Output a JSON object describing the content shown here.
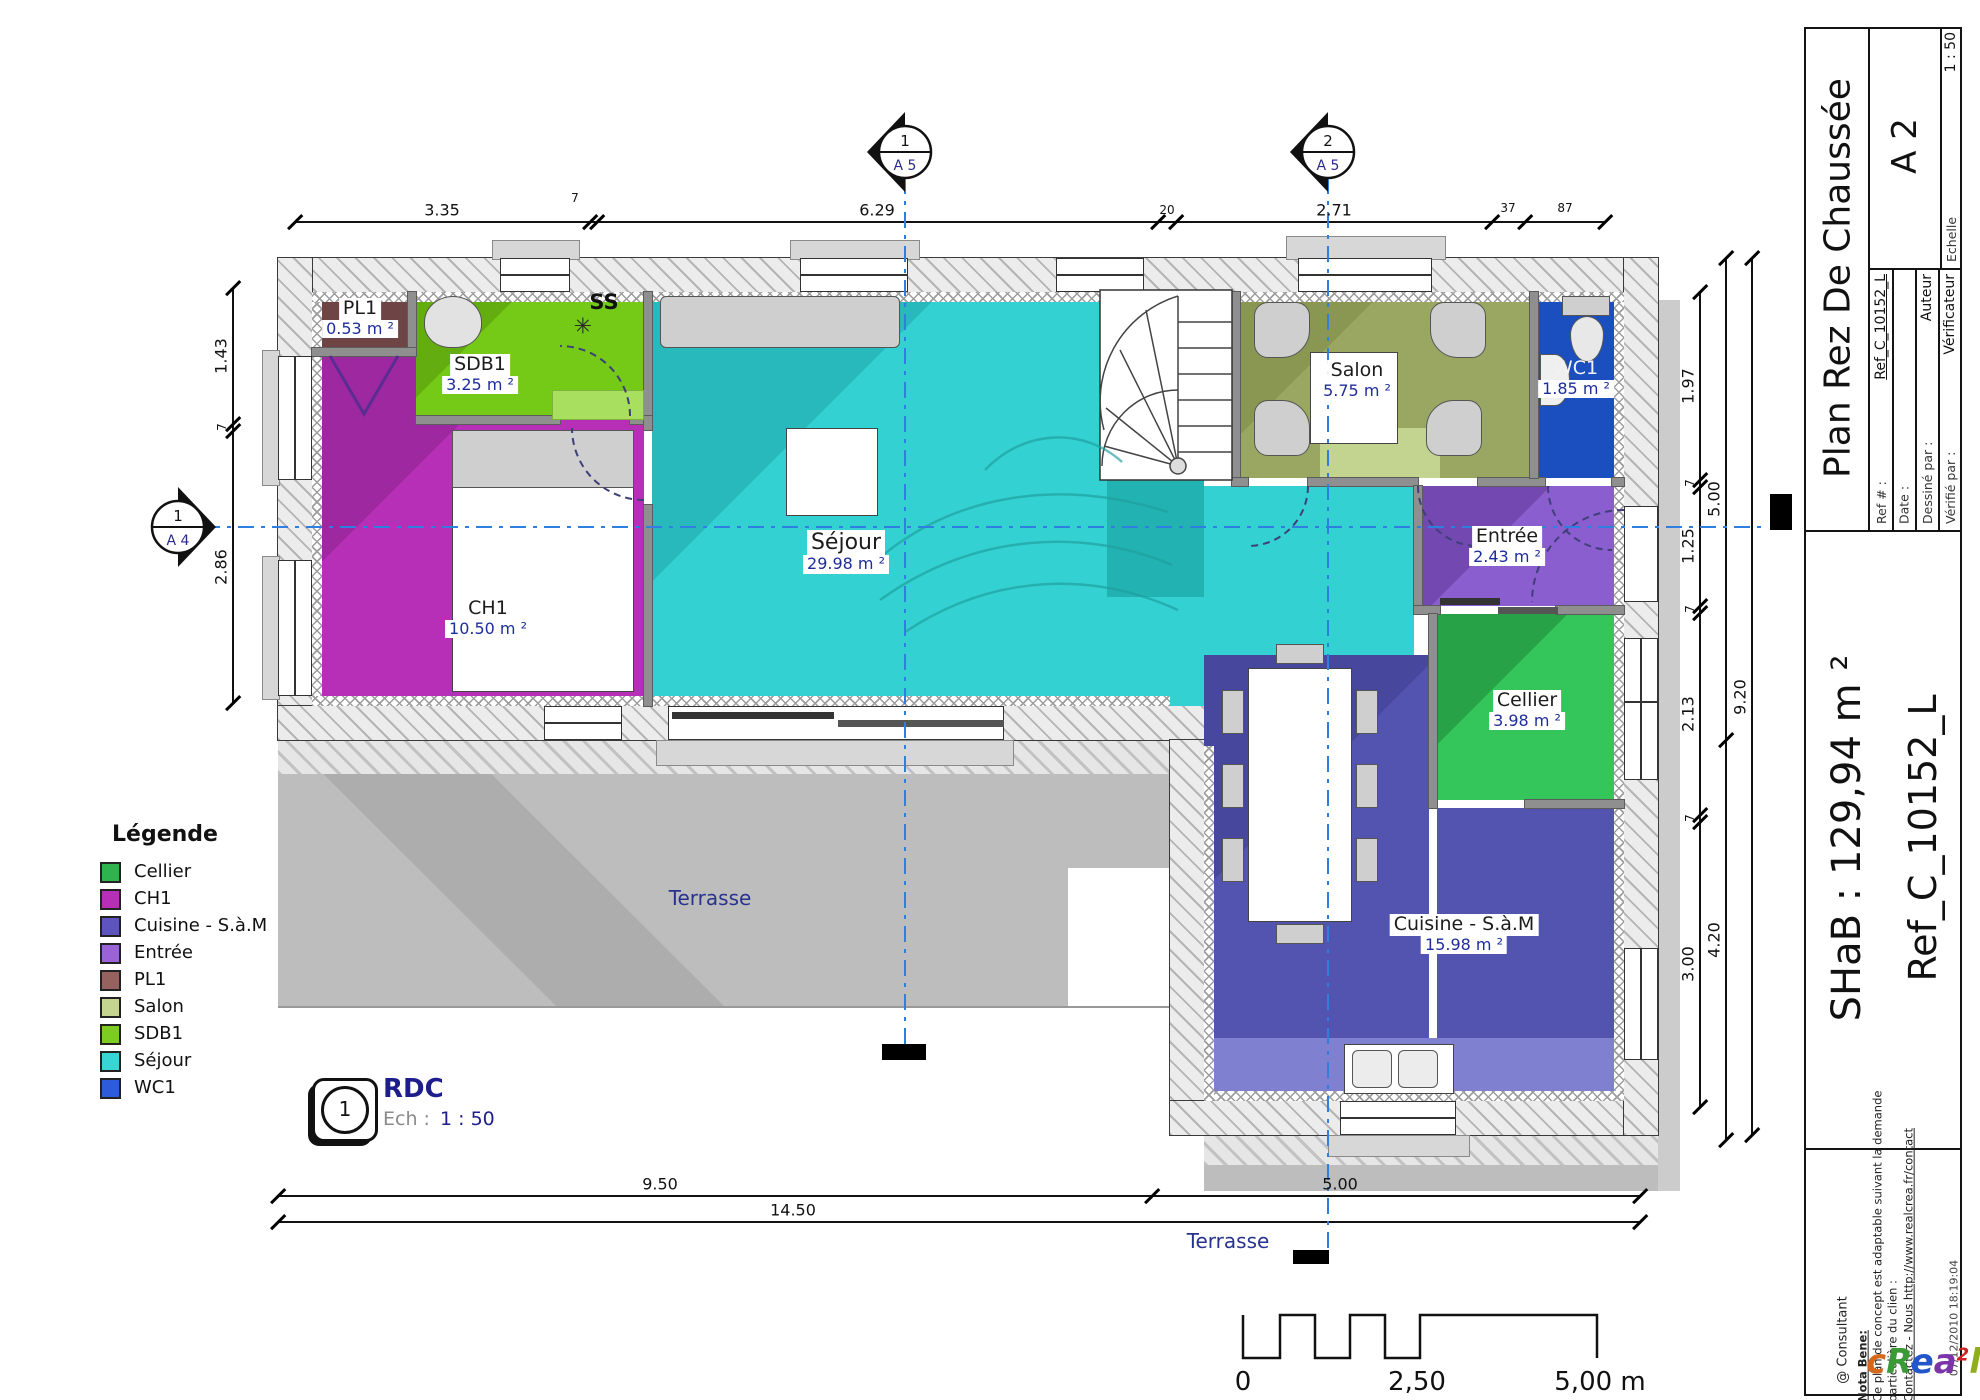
{
  "rooms": [
    {
      "name": "PL1",
      "area": "0.53 m ²",
      "color": "#6e4444"
    },
    {
      "name": "SDB1",
      "area": "3.25 m ²",
      "color": "#70c313"
    },
    {
      "name": "CH1",
      "area": "10.50 m ²",
      "color": "#b72fb7"
    },
    {
      "name": "Séjour",
      "area": "29.98 m ²",
      "color": "#33d1d1"
    },
    {
      "name": "Salon",
      "area": "5.75 m ²",
      "color": "#9aa763"
    },
    {
      "name": "WC1",
      "area": "1.85 m ²",
      "color": "#1b4fc0"
    },
    {
      "name": "Entrée",
      "area": "2.43 m ²",
      "color": "#8a5ecf"
    },
    {
      "name": "Cellier",
      "area": "3.98 m ²",
      "color": "#2db44f"
    },
    {
      "name": "Cuisine - S.à.M",
      "area": "15.98 m ²",
      "color": "#5353b0"
    }
  ],
  "annotations": {
    "ss": "SS",
    "terrasse_left": "Terrasse",
    "terrasse_bottom": "Terrasse"
  },
  "dims": {
    "top": [
      "3.35",
      "7",
      "6.29",
      "20",
      "2.71",
      "37",
      "87"
    ],
    "left": [
      "1.43",
      "7",
      "2.86"
    ],
    "right_a": [
      "1.97",
      "7",
      "1.25",
      "7",
      "2.13",
      "7",
      "3.00"
    ],
    "right_b": [
      "5.00",
      "4.20"
    ],
    "right_c": [
      "9.20"
    ],
    "bottom": [
      "9.50",
      "5.00",
      "14.50"
    ]
  },
  "markers": {
    "a5_1": {
      "num": "1",
      "sheet": "A 5"
    },
    "a5_2": {
      "num": "2",
      "sheet": "A 5"
    },
    "a4": {
      "num": "1",
      "sheet": "A 4"
    },
    "rdc": {
      "num": "1",
      "label": "RDC",
      "scale_label": "Ech :",
      "scale_value": "1 : 50"
    }
  },
  "legend": {
    "title": "Légende",
    "items": [
      {
        "label": "Cellier",
        "color": "#2db44f"
      },
      {
        "label": "CH1",
        "color": "#b72fb7"
      },
      {
        "label": "Cuisine - S.à.M",
        "color": "#5e54c0"
      },
      {
        "label": "Entrée",
        "color": "#9a63d8"
      },
      {
        "label": "PL1",
        "color": "#96625f"
      },
      {
        "label": "Salon",
        "color": "#c5d48e"
      },
      {
        "label": "SDB1",
        "color": "#7ccc22"
      },
      {
        "label": "Séjour",
        "color": "#39d5d5"
      },
      {
        "label": "WC1",
        "color": "#2e5bdc"
      }
    ]
  },
  "scalebar": {
    "start": "0",
    "mid": "2,50",
    "end": "5,00 m"
  },
  "titleblock": {
    "title": "Plan Rez De Chaussée",
    "sheet": "A 2",
    "echelle_label": "Echelle",
    "echelle_value": "1 : 50",
    "ref_label": "Ref # :",
    "ref_value": "Ref_C_10152_L",
    "date_label": "Date :",
    "date_value": "",
    "drawn_label": "Dessiné par :",
    "drawn_value": "Auteur",
    "checked_label": "Vérifié par :",
    "checked_value": "Vérificateur",
    "shab": "SHaB : 129,94 m ²",
    "ref_big": "Ref_C_10152_L",
    "notes": {
      "heading": "Nota Bene:",
      "line1": "Ce plan de concept est adaptable suivant la demande",
      "line2": "particulière du clien :",
      "line3": "Contactez - Nous http://www.realcrea.fr/contact"
    },
    "consultant": "@ Consultant",
    "datetime": "07/12/2010 18:19:04",
    "logo": [
      {
        "ch": "c"
      },
      {
        "ch": "R"
      },
      {
        "ch": "e"
      },
      {
        "ch": "a"
      },
      {
        "ch": "2"
      },
      {
        "ch": "l"
      }
    ]
  },
  "colors": {
    "axis_blue": "#2f7fe0",
    "label_blue": "#1e2d9c",
    "terrasse_text": "#27338f"
  }
}
